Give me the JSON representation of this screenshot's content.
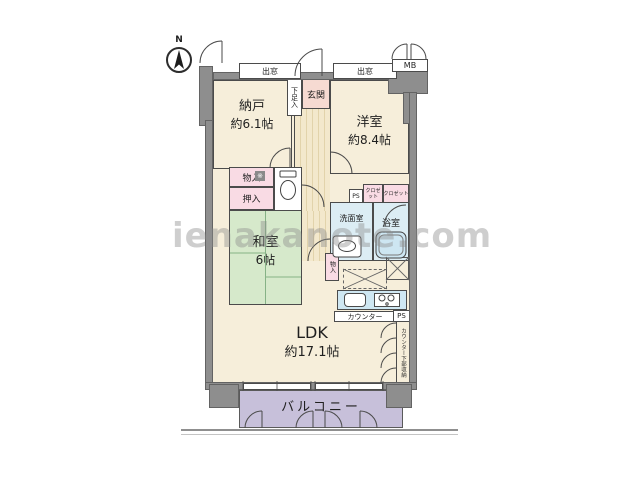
{
  "watermark": "ienakanote.com",
  "compass": {
    "north_label": "N"
  },
  "exterior": {
    "bay_window_left": "出窓",
    "bay_window_right": "出窓",
    "meter_box": "MB",
    "balcony_label": "バルコニー"
  },
  "rooms": {
    "nando": {
      "name": "納戸",
      "size": "約6.1帖"
    },
    "yoshitsu": {
      "name": "洋室",
      "size": "約8.4帖"
    },
    "washitsu": {
      "name": "和室",
      "size": "6帖"
    },
    "ldk": {
      "name": "LDK",
      "size": "約17.1帖"
    },
    "genkan": {
      "name": "玄関"
    },
    "senmenshitsu": {
      "name": "洗面室"
    },
    "yokushitsu": {
      "name": "浴室"
    }
  },
  "storage": {
    "geta_bako": "下足入",
    "mono_ire": "物入",
    "oshi_ire": "押入",
    "mono_ire_small": "物入",
    "closet_small": "クロゼット",
    "closet_large": "クロゼット",
    "counter_under": "カウンター下部収納",
    "note_mark": "※"
  },
  "kitchen": {
    "counter_label": "カウンター"
  },
  "utility": {
    "ps_1": "PS",
    "ps_2": "PS"
  },
  "icons": {
    "compass_icon": "compass needle pointing north",
    "toilet_icon": "toilet bowl and tank",
    "bathtub_icon": "bathtub",
    "sink_icon": "washbasin",
    "stove_icon": "two-burner stove",
    "refrigerator_space_icon": "dashed box with X",
    "storage_x_icon": "solid box with X",
    "door_arc_icon": "door swing arc",
    "window_icon": "window in wall"
  },
  "colors": {
    "room_floor": "#f6eeda",
    "tatami_green": "#d6e9cb",
    "storage_pink": "#f9dbe4",
    "entrance_pink": "#f6dad2",
    "wet_area_blue": "#dcedf4",
    "balcony_purple": "#c7c0da",
    "wall_gray": "#8e8e8e"
  }
}
